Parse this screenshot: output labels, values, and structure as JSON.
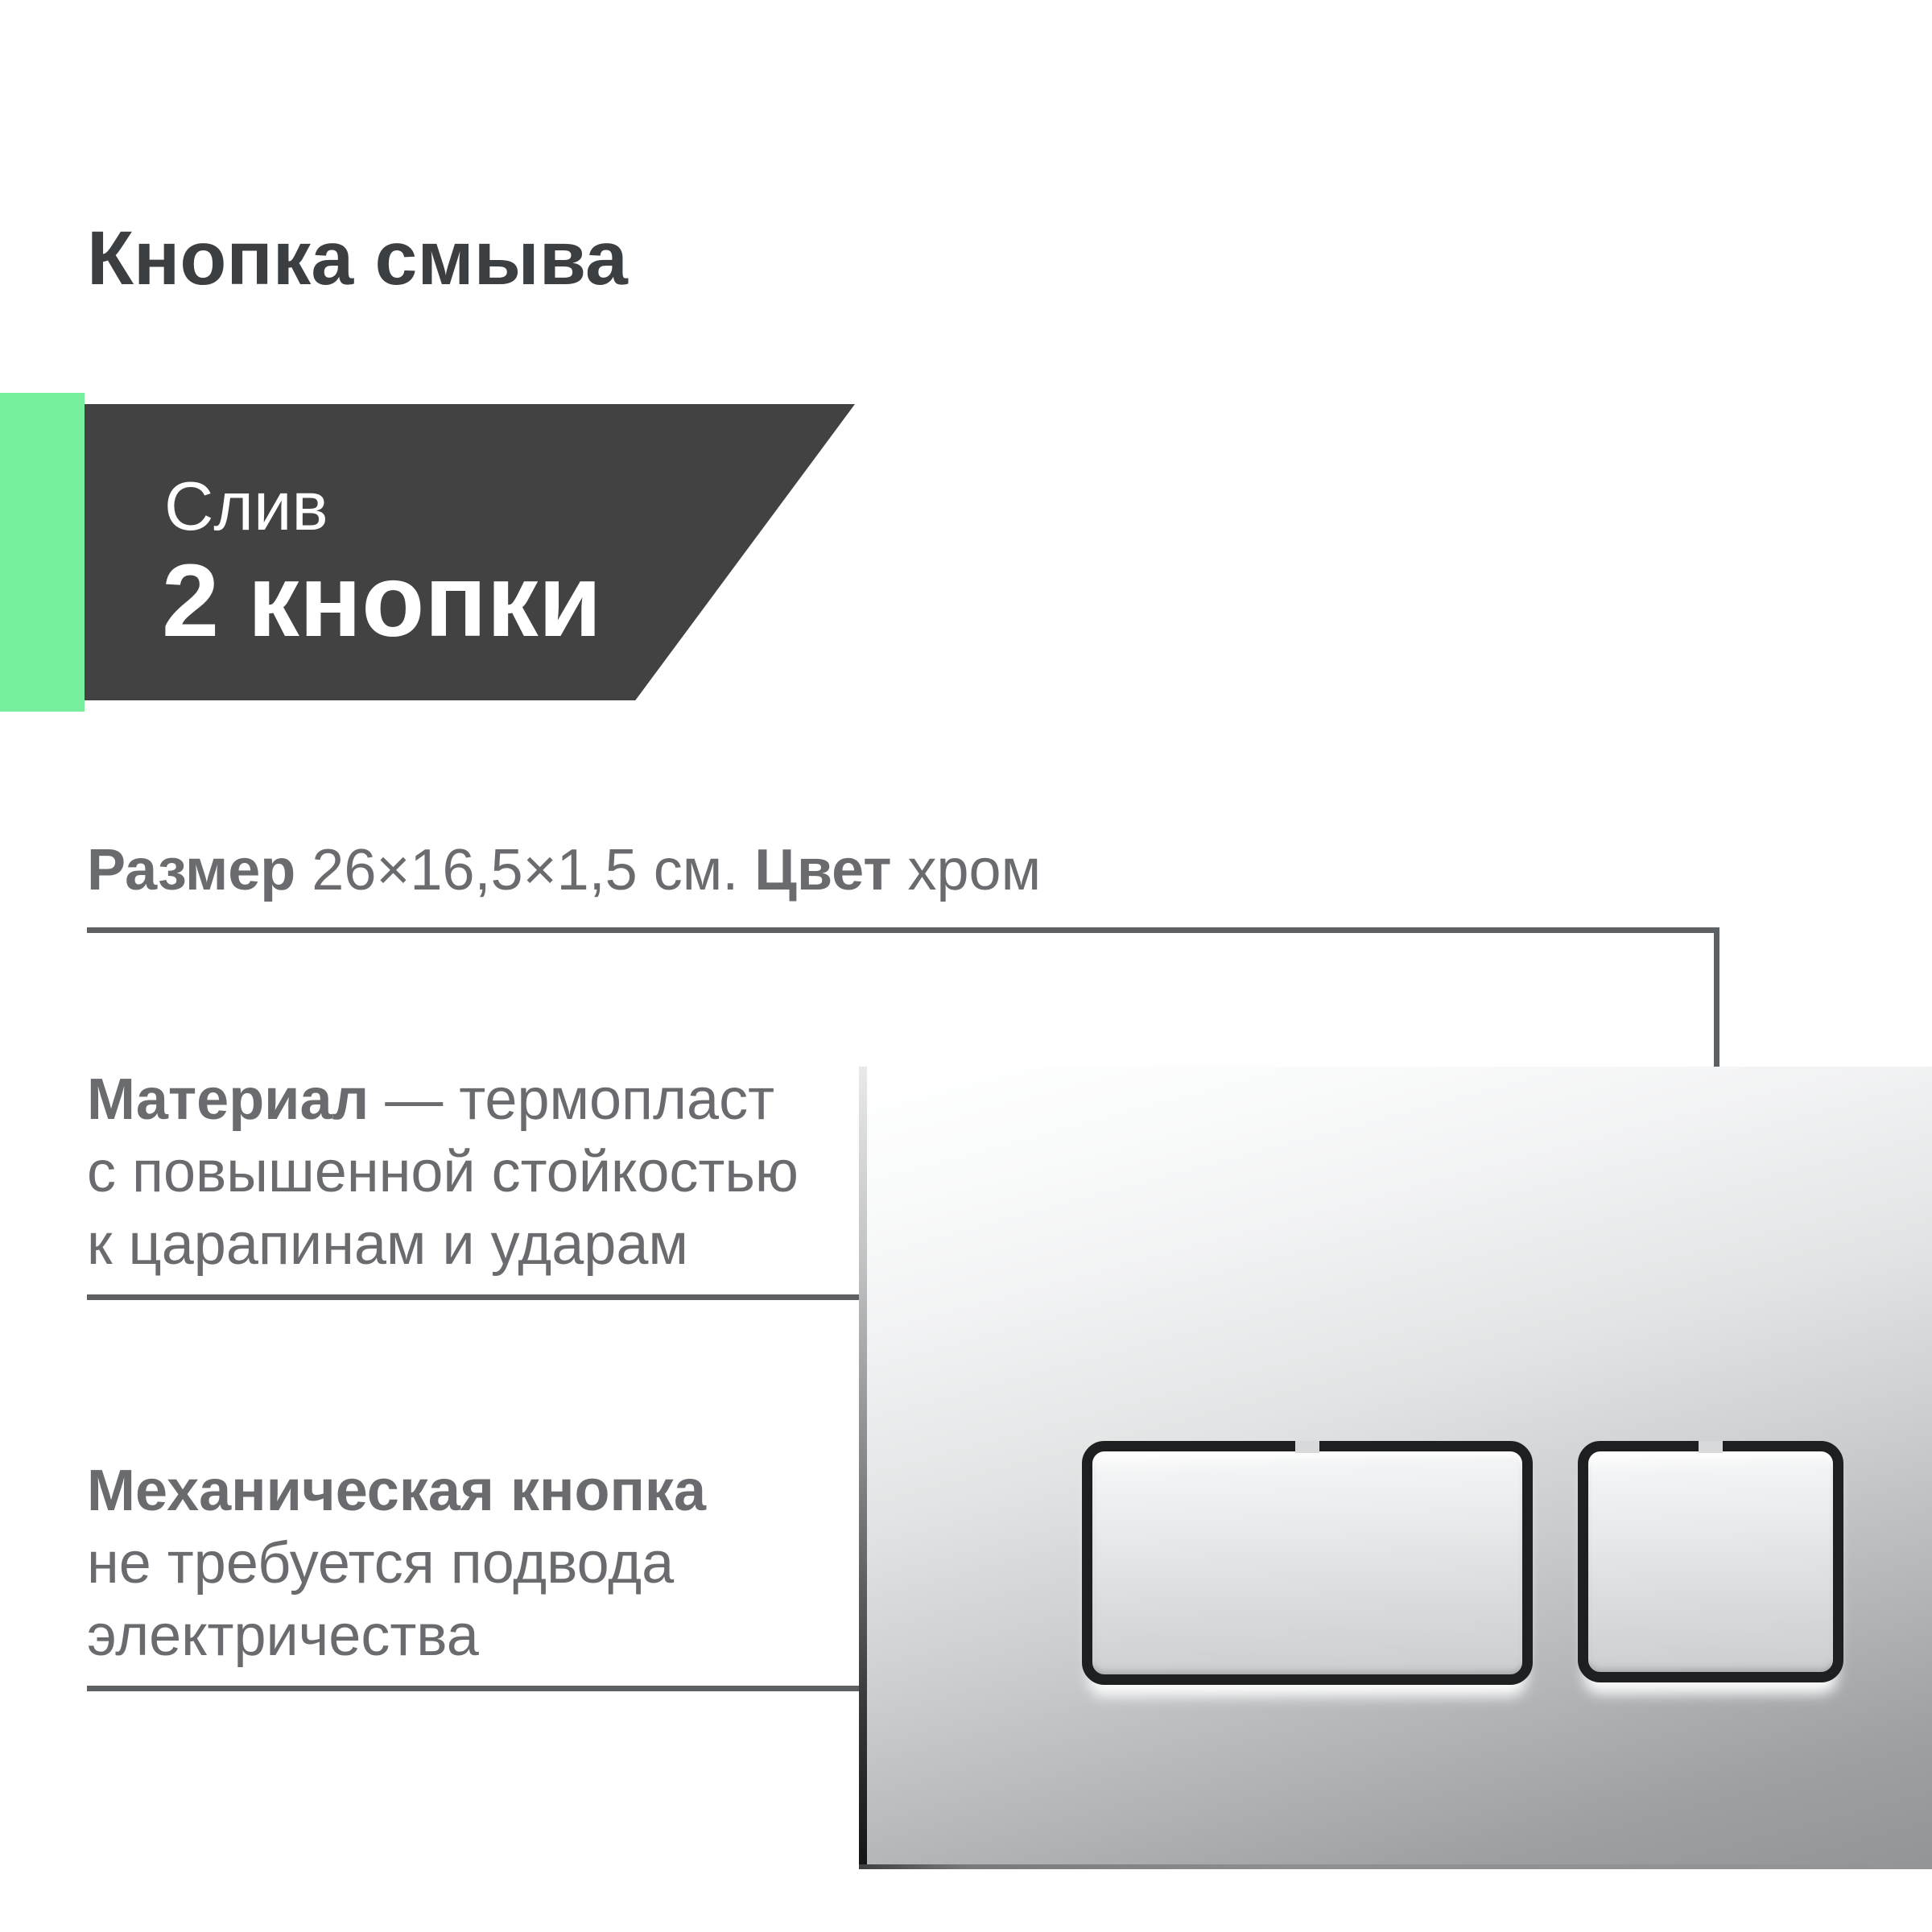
{
  "title": "Кнопка смыва",
  "badge": {
    "subtitle": "Слив",
    "value": "2 кнопки"
  },
  "spec_size": {
    "label": "Размер",
    "value": "26×16,5×1,5 см.",
    "label2": "Цвет",
    "value2": "хром"
  },
  "feature_material": {
    "label": "Материал",
    "rest1": "— термопласт",
    "line2": "с повышенной стойкостью",
    "line3": "к царапинам и ударам"
  },
  "feature_mechanical": {
    "label": "Механическая кнопка",
    "line2": "не требуется подвода",
    "line3": "электричества"
  },
  "product": {
    "image": "chrome-flush-plate-with-two-buttons"
  },
  "colors": {
    "accent_green": "#77EF9E",
    "badge_bg": "#424243",
    "title_text": "#3C3F41",
    "body_text": "#696B6E",
    "connector_gray": "#5E6164",
    "background": "#FFFFFF"
  }
}
